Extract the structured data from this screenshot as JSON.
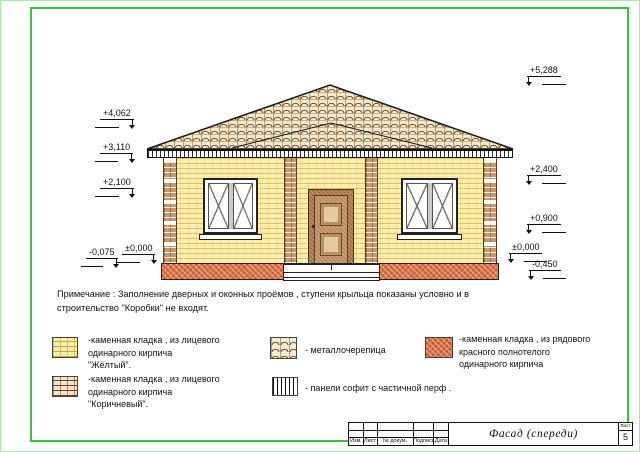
{
  "note": {
    "text": "Примечание : Заполнение дверных и оконных проёмов , ступени крыльца показаны условно и в\nстроительство \"Коробки\" не входят."
  },
  "elevation_marks": {
    "left": [
      "+4,062",
      "+3,110",
      "+2,100",
      "-0,075",
      "±0,000"
    ],
    "right": [
      "+5,288",
      "+2,400",
      "+0,900",
      "±0,000",
      "-0,450"
    ]
  },
  "legend": {
    "items": [
      {
        "swatch": "yellow-face-brick",
        "label": "-каменная кладка , из лицевого\nодинарного кирпича\n\"Жёлтый\"."
      },
      {
        "swatch": "brown-face-brick",
        "label": "-каменная кладка , из лицевого\nодинарного кирпича\n\"Коричневый\"."
      },
      {
        "swatch": "metal-roof-tile",
        "label": "- металлочерепица"
      },
      {
        "swatch": "soffit-panels",
        "label": "- панели софит с частичной перф ."
      },
      {
        "swatch": "red-solid-brick",
        "label": "-каменная кладка , из рядового\nкрасного полнотелого\nодинарного кирпича"
      }
    ]
  },
  "title_block": {
    "columns": [
      "Изм.",
      "Лист",
      "№ докум.",
      "Подпись",
      "Дата"
    ],
    "title": "Фасад (спереди)",
    "sheet_label": "Лист",
    "sheet_number": "5"
  },
  "colors": {
    "frame_green": "#3fbf3f",
    "wall_yellow": "#f9efad",
    "pilaster_brown": "#c9996b",
    "plinth_red": "#de7244",
    "roof_tan": "#f3e7cd"
  }
}
